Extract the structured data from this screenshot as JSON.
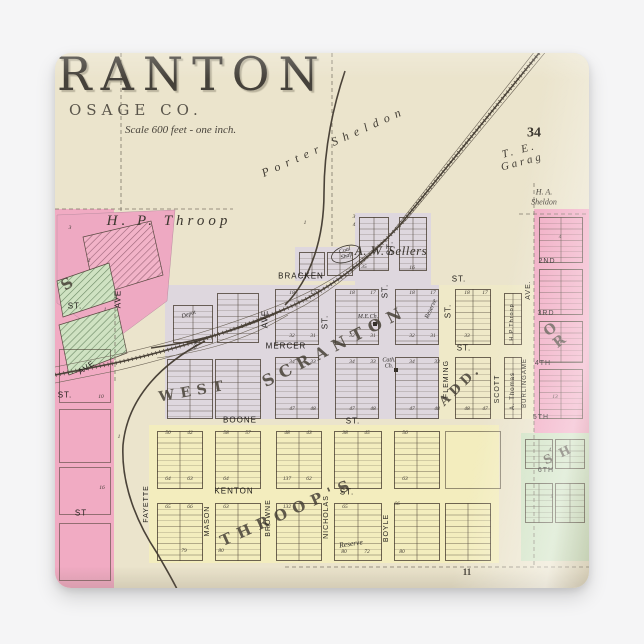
{
  "map": {
    "title": "RANTON",
    "subtitle": "OSAGE CO.",
    "scale_note": "Scale 600 feet - one inch.",
    "colors": {
      "paper": "#ebe4cc",
      "lavender": "#ded7de",
      "yellow": "#f3edbe",
      "cream": "#efe9c8",
      "pink": "#f1abc3",
      "green": "#cfe2c2",
      "ink": "#4a4238"
    },
    "regions": [
      [
        110,
        232,
        274,
        134,
        "lav"
      ],
      [
        240,
        194,
        62,
        34,
        "lav"
      ],
      [
        300,
        160,
        76,
        72,
        "lav"
      ],
      [
        384,
        232,
        95,
        134,
        "cream"
      ],
      [
        94,
        372,
        350,
        138,
        "yellow"
      ],
      [
        479,
        156,
        55,
        228,
        "pink"
      ],
      [
        466,
        380,
        68,
        128,
        "green"
      ],
      [
        0,
        156,
        59,
        380,
        "pink"
      ]
    ],
    "blocks": [
      [
        244,
        199,
        24,
        22
      ],
      [
        272,
        199,
        24,
        22
      ],
      [
        304,
        164,
        28,
        52
      ],
      [
        344,
        164,
        26,
        52
      ],
      [
        118,
        252,
        38,
        36
      ],
      [
        162,
        240,
        40,
        48
      ],
      [
        220,
        236,
        42,
        54
      ],
      [
        280,
        236,
        42,
        54
      ],
      [
        340,
        236,
        42,
        54
      ],
      [
        400,
        236,
        34,
        54
      ],
      [
        449,
        240,
        16,
        50
      ],
      [
        112,
        306,
        44,
        58
      ],
      [
        160,
        306,
        44,
        58
      ],
      [
        220,
        304,
        42,
        60
      ],
      [
        280,
        304,
        42,
        60
      ],
      [
        340,
        304,
        42,
        60
      ],
      [
        400,
        304,
        34,
        60
      ],
      [
        449,
        304,
        16,
        60
      ],
      [
        102,
        378,
        44,
        56
      ],
      [
        160,
        378,
        44,
        56
      ],
      [
        221,
        378,
        44,
        56
      ],
      [
        279,
        378,
        46,
        56
      ],
      [
        339,
        378,
        44,
        56
      ],
      [
        390,
        378,
        54,
        56,
        "plain"
      ],
      [
        102,
        450,
        44,
        56
      ],
      [
        160,
        450,
        44,
        56
      ],
      [
        221,
        450,
        44,
        56
      ],
      [
        279,
        450,
        46,
        56
      ],
      [
        339,
        450,
        44,
        56
      ],
      [
        390,
        450,
        44,
        56
      ],
      [
        484,
        164,
        42,
        44
      ],
      [
        484,
        216,
        42,
        44
      ],
      [
        484,
        268,
        42,
        40
      ],
      [
        484,
        316,
        42,
        48
      ],
      [
        470,
        386,
        26,
        28
      ],
      [
        500,
        386,
        28,
        28
      ],
      [
        470,
        430,
        26,
        38
      ],
      [
        500,
        430,
        28,
        38
      ],
      [
        4,
        296,
        50,
        52,
        "plain"
      ],
      [
        4,
        356,
        50,
        52,
        "plain"
      ],
      [
        4,
        414,
        50,
        46,
        "plain"
      ],
      [
        4,
        470,
        50,
        56,
        "plain"
      ]
    ],
    "svg": [
      {
        "t": "poly",
        "p": "2,162 120,157 112,248 58,288 2,250",
        "c": "wpink"
      },
      {
        "t": "poly",
        "p": "28,184 96,168 108,222 40,243",
        "c": "phatch"
      },
      {
        "t": "poly",
        "p": "2,228 54,210 62,246 8,264",
        "c": "ghatch"
      },
      {
        "t": "poly",
        "p": "4,272 62,254 72,300 14,322",
        "c": "ghatch"
      },
      {
        "t": "path",
        "d": "M66,0 L66,158",
        "c": "dash"
      },
      {
        "t": "path",
        "d": "M277,0 L277,196",
        "c": "dash"
      },
      {
        "t": "path",
        "d": "M479,130 L479,512",
        "c": "dash"
      },
      {
        "t": "path",
        "d": "M0,156 L178,156",
        "c": "dash"
      },
      {
        "t": "path",
        "d": "M230,514 L534,514",
        "c": "dash"
      },
      {
        "t": "path",
        "d": "M464,161 L534,161",
        "c": "dash"
      },
      {
        "t": "path",
        "d": "M60,240 L60,330",
        "c": "dash"
      },
      {
        "t": "path",
        "d": "M498,-10 L352,166 Q296,222 234,248 Q152,282 60,302 L0,314",
        "c": "rr-thin"
      },
      {
        "t": "path",
        "d": "M480,-2 L338,178 Q286,238 226,264 Q148,298 60,318 L0,330",
        "c": "rr-thin"
      },
      {
        "t": "path",
        "d": "M489,-6 L345,172 Q291,230 230,256 Q150,290 60,310 L0,322",
        "c": "rr-main"
      },
      {
        "t": "path",
        "d": "M489,-6 L345,172 Q291,230 230,256 Q150,290 60,310 L0,322",
        "c": "rr-ticks"
      },
      {
        "t": "path",
        "d": "M290,18 C276,60 269,100 269,140 C269,185 256,226 230,252",
        "c": "rr-main"
      },
      {
        "t": "path",
        "d": "M230,256 C185,278 140,289 96,295",
        "c": "rr-main"
      },
      {
        "t": "path",
        "d": "M233,262 C190,288 148,299 102,305",
        "c": "rr-thin"
      },
      {
        "t": "path",
        "d": "M150,288 C100,314 72,350 68,392 C66,432 82,470 102,500 C110,514 116,524 122,536",
        "c": "rr-main"
      },
      {
        "t": "ell",
        "cx": 291,
        "cy": 201,
        "rx": 15,
        "ry": 8,
        "r": -18,
        "c": "oval"
      },
      {
        "t": "rect",
        "x": 318,
        "y": 269,
        "w": 4,
        "h": 4,
        "c": "church"
      },
      {
        "t": "rect",
        "x": 339,
        "y": 315,
        "w": 4,
        "h": 4,
        "c": "church"
      }
    ],
    "labels": {
      "landowner": {
        "cls": "landowner",
        "s": 13,
        "items": [
          {
            "t": "H. P.  Throop",
            "x": 114,
            "y": 168,
            "s": 15,
            "ls": 4
          },
          {
            "t": "A. W. Sellers",
            "x": 336,
            "y": 198,
            "s": 13,
            "ls": 0.5
          },
          {
            "t": "H. A.",
            "x": 489,
            "y": 140,
            "s": 8
          },
          {
            "t": "Sheldon",
            "x": 489,
            "y": 150,
            "s": 8
          }
        ]
      },
      "railroad": {
        "cls": "rr",
        "s": 12,
        "items": [
          {
            "t": "Porter  Sheldon",
            "x": 279,
            "y": 89,
            "r": -24,
            "s": 12,
            "ls": 6
          },
          {
            "t": "T.  E.  Garag",
            "x": 466,
            "y": 104,
            "r": -15,
            "s": 11,
            "ls": 3
          }
        ]
      },
      "section": {
        "cls": "section",
        "s": 14,
        "items": [
          {
            "t": "34",
            "x": 479,
            "y": 80,
            "s": 14
          },
          {
            "t": "11",
            "x": 412,
            "y": 520,
            "s": 9
          }
        ]
      },
      "district": {
        "cls": "district",
        "s": 15,
        "items": [
          {
            "t": "WEST",
            "x": 139,
            "y": 339,
            "r": -10,
            "s": 14,
            "ls": 6
          },
          {
            "t": "SCRANTON",
            "x": 280,
            "y": 293,
            "r": -27,
            "s": 16,
            "ls": 7
          },
          {
            "t": "ADD.",
            "x": 406,
            "y": 333,
            "r": -44,
            "s": 13,
            "ls": 4
          },
          {
            "t": "THROOP'S",
            "x": 233,
            "y": 459,
            "r": -24,
            "s": 15,
            "ls": 7
          },
          {
            "t": "O R",
            "x": 502,
            "y": 282,
            "r": -38,
            "s": 14,
            "ls": 4
          },
          {
            "t": "S H",
            "x": 503,
            "y": 402,
            "r": -25,
            "s": 12,
            "ls": 2
          },
          {
            "t": "S",
            "x": 12,
            "y": 231,
            "r": -35,
            "s": 15
          }
        ]
      },
      "street_h": {
        "cls": "street",
        "s": 8,
        "ls": 1,
        "items": [
          {
            "t": "BRACKEN",
            "x": 246,
            "y": 224
          },
          {
            "t": "ST.",
            "x": 404,
            "y": 227
          },
          {
            "t": "MERCER",
            "x": 231,
            "y": 294
          },
          {
            "t": "ST.",
            "x": 409,
            "y": 296
          },
          {
            "t": "BOONE",
            "x": 185,
            "y": 368
          },
          {
            "t": "ST.",
            "x": 298,
            "y": 369
          },
          {
            "t": "KENTON",
            "x": 179,
            "y": 439
          },
          {
            "t": "ST.",
            "x": 292,
            "y": 440
          },
          {
            "t": "2ND",
            "x": 492,
            "y": 209,
            "s": 7
          },
          {
            "t": "3RD",
            "x": 491,
            "y": 261,
            "s": 7
          },
          {
            "t": "4TH",
            "x": 488,
            "y": 311,
            "s": 7
          },
          {
            "t": "5TH",
            "x": 486,
            "y": 365,
            "s": 7
          },
          {
            "t": "6TH",
            "x": 491,
            "y": 418,
            "s": 7
          },
          {
            "t": "ST.",
            "x": 20,
            "y": 254
          },
          {
            "t": "ST.",
            "x": 10,
            "y": 343
          },
          {
            "t": "ST",
            "x": 26,
            "y": 461
          }
        ]
      },
      "street_v": {
        "cls": "street",
        "s": 8,
        "ls": 1,
        "dr": -90,
        "items": [
          {
            "t": "AVE",
            "x": 211,
            "y": 266
          },
          {
            "t": "ST.",
            "x": 271,
            "y": 269
          },
          {
            "t": "ST.",
            "x": 331,
            "y": 238
          },
          {
            "t": "ST.",
            "x": 336,
            "y": 195
          },
          {
            "t": "ST.",
            "x": 394,
            "y": 258
          },
          {
            "t": "FLEMING",
            "x": 392,
            "y": 326,
            "s": 7
          },
          {
            "t": "SCOTT",
            "x": 443,
            "y": 336,
            "s": 7
          },
          {
            "t": "BURLINGAME",
            "x": 470,
            "y": 330,
            "s": 6
          },
          {
            "t": "AVE.",
            "x": 474,
            "y": 237,
            "s": 7
          },
          {
            "t": "AVE",
            "x": 64,
            "y": 246
          },
          {
            "t": "AVE",
            "x": 32,
            "y": 315,
            "r": -35
          },
          {
            "t": "FAYETTE",
            "x": 92,
            "y": 451,
            "s": 7
          },
          {
            "t": "MASON",
            "x": 153,
            "y": 468,
            "s": 7
          },
          {
            "t": "BROWNE",
            "x": 214,
            "y": 465,
            "s": 7
          },
          {
            "t": "NICHOLAS",
            "x": 272,
            "y": 464,
            "s": 7
          },
          {
            "t": "BOYLE",
            "x": 332,
            "y": 475,
            "s": 7
          },
          {
            "t": "H.P.Throop",
            "x": 458,
            "y": 269,
            "s": 5.5
          },
          {
            "t": "A. Thomas",
            "x": 458,
            "y": 338,
            "s": 6
          }
        ]
      },
      "poi": {
        "cls": "poi",
        "s": 6,
        "items": [
          {
            "t": "Coal\nShaft",
            "x": 291,
            "y": 201,
            "r": -18,
            "s": 6
          },
          {
            "t": "M.E.Ch.",
            "x": 313,
            "y": 264,
            "s": 6
          },
          {
            "t": "Cath.\nCh.",
            "x": 334,
            "y": 311,
            "s": 6
          },
          {
            "t": "Depot",
            "x": 134,
            "y": 262,
            "r": -18,
            "s": 6
          },
          {
            "t": "Coal",
            "x": 141,
            "y": 291,
            "r": -90,
            "s": 5
          },
          {
            "t": "Reserve",
            "x": 376,
            "y": 256,
            "r": -65,
            "s": 6.5
          },
          {
            "t": "Reserve",
            "x": 296,
            "y": 491,
            "r": -8,
            "s": 7.5
          }
        ]
      },
      "number": {
        "cls": "num",
        "s": 5.5,
        "items": [
          [
            "1",
            250,
            171
          ],
          [
            "3",
            299,
            165
          ],
          [
            "4",
            299,
            173
          ],
          [
            "35",
            309,
            215
          ],
          [
            "16",
            357,
            216
          ],
          [
            "18",
            237,
            241
          ],
          [
            "17",
            258,
            241
          ],
          [
            "18",
            297,
            241
          ],
          [
            "17",
            318,
            241
          ],
          [
            "18",
            357,
            241
          ],
          [
            "17",
            378,
            241
          ],
          [
            "18",
            412,
            241
          ],
          [
            "17",
            430,
            241
          ],
          [
            "32",
            237,
            284
          ],
          [
            "31",
            258,
            284
          ],
          [
            "32",
            297,
            284
          ],
          [
            "31",
            318,
            284
          ],
          [
            "32",
            357,
            284
          ],
          [
            "31",
            378,
            284
          ],
          [
            "33",
            412,
            284
          ],
          [
            "34",
            237,
            310
          ],
          [
            "33",
            258,
            310
          ],
          [
            "34",
            297,
            310
          ],
          [
            "33",
            318,
            310
          ],
          [
            "34",
            357,
            310
          ],
          [
            "33",
            382,
            310
          ],
          [
            "47",
            237,
            357
          ],
          [
            "48",
            258,
            357
          ],
          [
            "47",
            297,
            357
          ],
          [
            "48",
            318,
            357
          ],
          [
            "47",
            357,
            357
          ],
          [
            "48",
            382,
            357
          ],
          [
            "48",
            412,
            357
          ],
          [
            "47",
            430,
            357
          ],
          [
            "50",
            113,
            381
          ],
          [
            "42",
            135,
            381
          ],
          [
            "58",
            171,
            381
          ],
          [
            "57",
            193,
            381
          ],
          [
            "48",
            232,
            381
          ],
          [
            "43",
            254,
            381
          ],
          [
            "38",
            290,
            381
          ],
          [
            "45",
            312,
            381
          ],
          [
            "56",
            350,
            381
          ],
          [
            "64",
            113,
            427
          ],
          [
            "63",
            135,
            427
          ],
          [
            "64",
            171,
            427
          ],
          [
            "137",
            232,
            427
          ],
          [
            "62",
            254,
            427
          ],
          [
            "63",
            350,
            427
          ],
          [
            "65",
            113,
            455
          ],
          [
            "66",
            135,
            455
          ],
          [
            "63",
            171,
            455
          ],
          [
            "132",
            232,
            455
          ],
          [
            "65",
            290,
            455
          ],
          [
            "66",
            342,
            452
          ],
          [
            "79",
            129,
            499
          ],
          [
            "80",
            166,
            499
          ],
          [
            "80",
            289,
            500
          ],
          [
            "72",
            312,
            500
          ],
          [
            "80",
            347,
            500
          ],
          [
            "4",
            505,
            185
          ],
          [
            "12",
            505,
            290
          ],
          [
            "13",
            500,
            345
          ],
          [
            "4",
            495,
            398
          ],
          [
            "5",
            497,
            445
          ],
          [
            "10",
            46,
            345
          ],
          [
            "1",
            64,
            385
          ],
          [
            "16",
            47,
            436
          ],
          [
            "3",
            15,
            176
          ],
          [
            "2",
            34,
            209
          ],
          [
            "1",
            50,
            258
          ]
        ]
      }
    }
  }
}
